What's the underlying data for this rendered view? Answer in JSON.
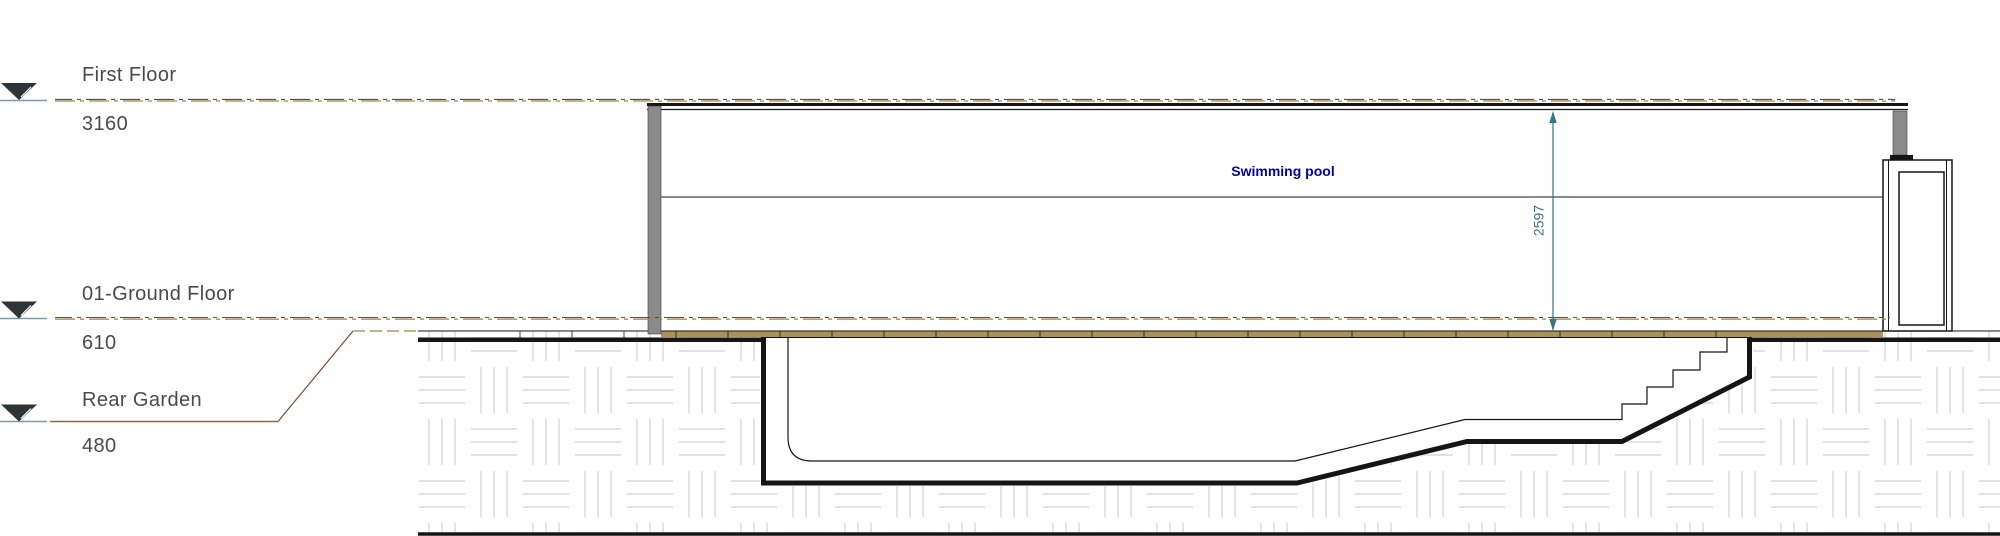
{
  "drawing": {
    "levels": [
      {
        "label": "First Floor",
        "value": "3160"
      },
      {
        "label": "01-Ground Floor",
        "value": "610"
      },
      {
        "label": "Rear Garden",
        "value": "480"
      }
    ],
    "room_label": "Swimming pool",
    "dimension": {
      "value": "2597"
    }
  },
  "colors": {
    "ink": "#151515",
    "labelgray": "#4a4a4a",
    "navy": "#0000a0",
    "teal": "#3a7383",
    "tan": "#ad9257",
    "tanline": "#a3813f",
    "dashdark": "#4f4f4f",
    "leader": "#7b4a33",
    "underline": "#8a6a3e",
    "marker": "#2e3537",
    "markerline": "#7b9dab",
    "wallgray": "#8a8a8a",
    "hatch": "#d8d8d8"
  }
}
